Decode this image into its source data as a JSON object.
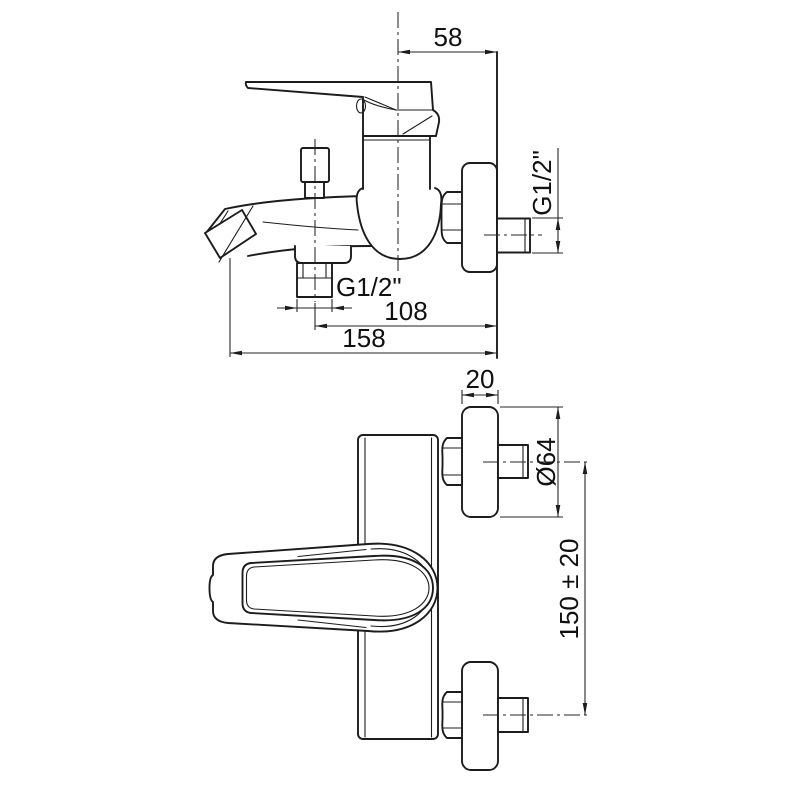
{
  "colors": {
    "background": "#ffffff",
    "line": "#1c1c1c"
  },
  "views": {
    "side": {
      "dimensions": {
        "body_center_to_wall": "58",
        "shower_outlet_thread": "G1/2\"",
        "wall_inlet_thread": "G1/2\"",
        "outlet_to_wall": "108",
        "spout_reach": "158"
      }
    },
    "front": {
      "dimensions": {
        "escutcheon_depth": "20",
        "escutcheon_diameter": "Ø64",
        "inlet_spacing": "150 ± 20"
      }
    }
  }
}
